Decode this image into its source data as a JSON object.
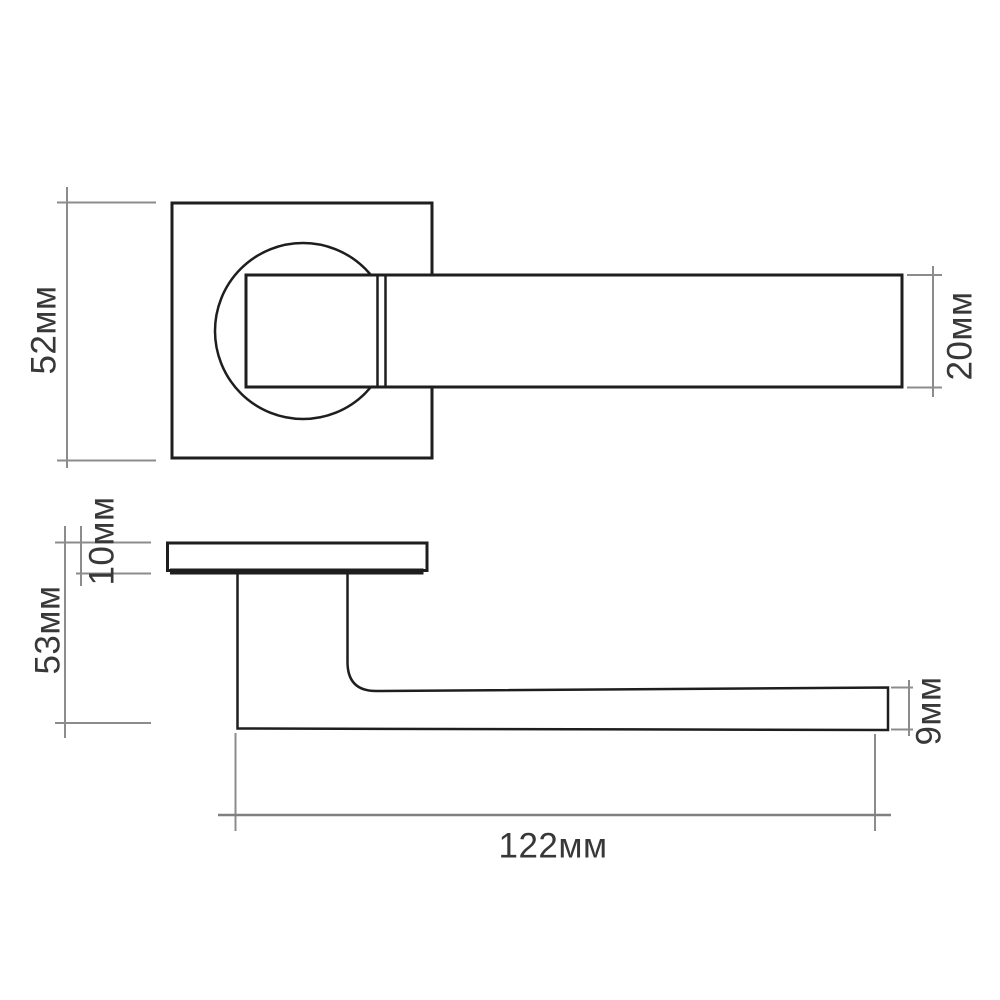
{
  "diagram": {
    "type": "technical-drawing",
    "subject": "door-handle-on-square-rosette",
    "units": "мм",
    "dimensions": {
      "rosette_size": "52мм",
      "grip_width": "20мм",
      "rosette_thickness": "10мм",
      "handle_depth": "53мм",
      "grip_thickness": "9мм",
      "handle_length": "122мм"
    },
    "colors": {
      "outline": "#1e1e1e",
      "dimension_lines": "#8c8c8c",
      "label_text": "#383838",
      "background": "#ffffff"
    }
  }
}
